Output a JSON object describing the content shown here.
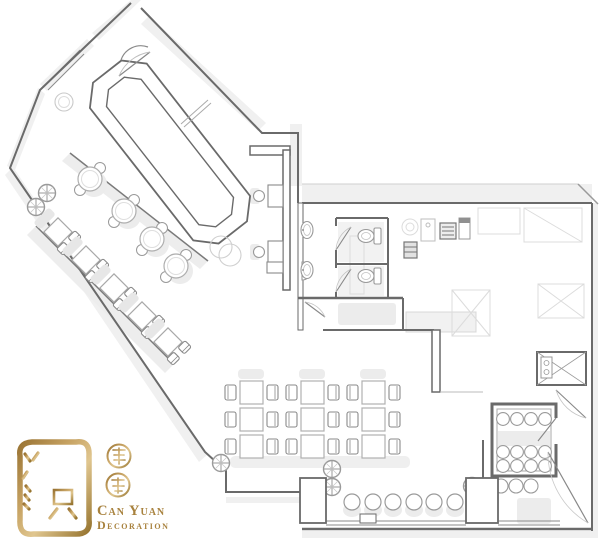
{
  "brand": {
    "name_line1": "Can Yuan",
    "name_line2": "Decoration",
    "seal_characters": "灿源",
    "side_characters": "装饰"
  },
  "colors": {
    "gold": "#b5914f",
    "gold_dark": "#97732f",
    "gold_light": "#dfc68f",
    "wall_gray": "#6a6a6a",
    "furniture_gray": "#9a9a9a",
    "light_fill": "#ececec",
    "shadow_gray": "#f0f0f0",
    "background": "#ffffff"
  },
  "plan": {
    "areas": [
      "entrance",
      "bar-island",
      "lounge-round-tables",
      "banquette-square-tables",
      "restroom-stalls",
      "kitchen",
      "dining-grid",
      "window-bar",
      "wine-storage",
      "dumbwaiter",
      "rear-corridor"
    ],
    "counts": {
      "round_tables": 4,
      "banquette_tables": 5,
      "dining_tables": 9,
      "bar_stools": 6,
      "restroom_stalls": 2,
      "sinks": 2,
      "columns": 6,
      "wine_rack_circles": 12
    }
  }
}
